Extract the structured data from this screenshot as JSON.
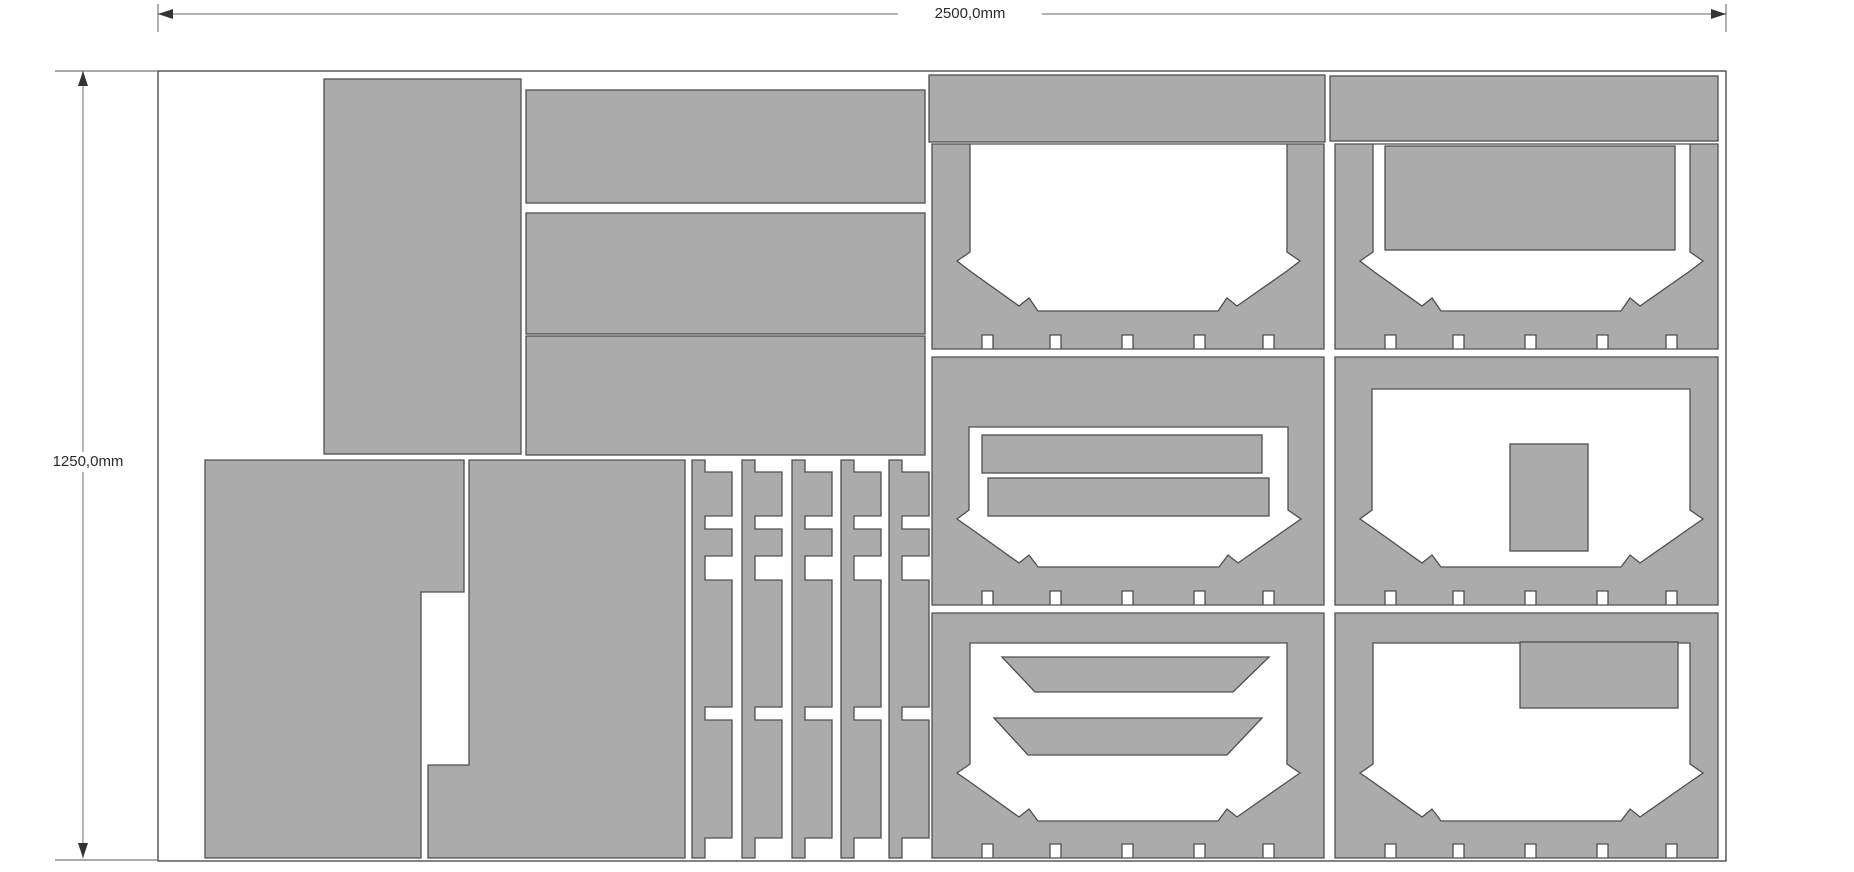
{
  "diagram": {
    "type": "sheet-nesting-cut-layout",
    "sheet": {
      "width_label": "2500,0mm",
      "height_label": "1250,0mm",
      "width_mm": 2500,
      "height_mm": 1250
    },
    "colors": {
      "background": "#ffffff",
      "part_fill": "#ababab",
      "part_stroke": "#4f4f4f",
      "sheet_outline": "#2f2f2f",
      "dimension_line": "#999999",
      "dimension_arrow": "#333333",
      "dimension_text": "#2b2b2b"
    },
    "parts_summary": [
      {
        "name": "vertical-rectangle-panel",
        "count": 1
      },
      {
        "name": "horizontal-rectangle-panel",
        "count": 3
      },
      {
        "name": "l-shaped-side-panel",
        "count": 2
      },
      {
        "name": "notched-comb-strip",
        "count": 5
      },
      {
        "name": "top-filler-strip",
        "count": 2
      },
      {
        "name": "open-top-tub-panel",
        "count": 2
      },
      {
        "name": "slotted-panel-with-bars",
        "count": 2
      },
      {
        "name": "slotted-panel-with-insert-block",
        "count": 2
      },
      {
        "name": "rectangle-insert-bar",
        "count": 3
      },
      {
        "name": "trapezoid-insert-bar",
        "count": 2
      },
      {
        "name": "insert-block",
        "count": 2
      }
    ]
  }
}
